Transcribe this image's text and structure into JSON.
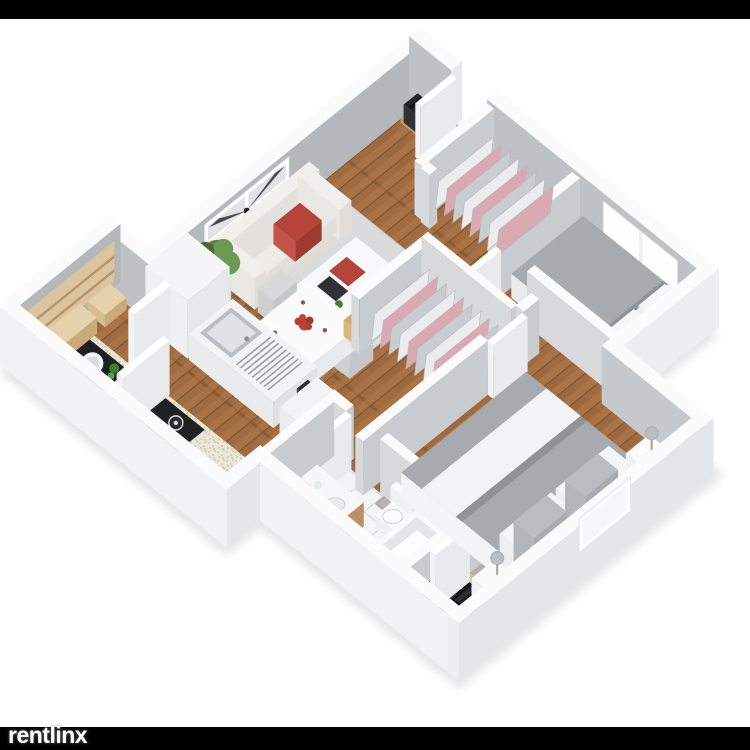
{
  "meta": {
    "image_type": "3d-isometric-floor-plan-render",
    "bedrooms": 2,
    "bathrooms": 1
  },
  "watermark": {
    "brand": "rentlinx"
  },
  "canvas": {
    "background": "#ffffff",
    "bar_color": "#000000",
    "watermark_color": "#ffffff"
  },
  "palette": {
    "wall_top": "#fbfbfc",
    "wall_inner": "#b5b8ba",
    "wall_inner_light": "#bfc2c4",
    "wall_outer_sw": "#f1f2f3",
    "wall_outer_se": "#e4e6e8",
    "wall_int_se": "#c9ccce",
    "wall_int_sw": "#d7d9db",
    "wood_a": "#a06b41",
    "wood_b": "#b07a4a",
    "wood_dark": "#7e5230",
    "tile": "#f3f4f5",
    "grout": "#c7cacc",
    "rug_living": "#d9dbdd",
    "rug_master": "#b9b1ac",
    "cream": "#edece7",
    "red": "#b5453a",
    "red_dark": "#9e3a30",
    "green": "#5c8346",
    "green_dark": "#47692f",
    "furn_wood": "#cda973",
    "furn_wood_light": "#dcc49e",
    "steel": "#b9bec2",
    "steel_light": "#dfe3e5",
    "black": "#202123",
    "bed_gray": "#a7abad",
    "linen_white": "#f2f3f4",
    "clothes_pink": "#d9a9b4",
    "clothes_gray": "#c9cdd0",
    "counter_base": "#eae6d8",
    "counter_dot": "#c6bfa8"
  },
  "scene": {
    "style": "isometric",
    "rooms": [
      {
        "name": "living-dining-room",
        "floor": "hardwood",
        "furniture": [
          "sofa",
          "red-throw-pillow",
          "wall-art",
          "potted-plant",
          "area-rug-living",
          "coffee-table",
          "pouf",
          "dining-chairs",
          "dining-table",
          "flower-centerpiece"
        ]
      },
      {
        "name": "entry-hall",
        "floor": "hardwood",
        "furniture": [
          "shoe-bench",
          "entry-door",
          "coat-closet",
          "tv-console",
          "television"
        ]
      },
      {
        "name": "bedroom-small",
        "floor": "hardwood",
        "furniture": [
          "bed-small",
          "bedroom-window",
          "closet-rack-small"
        ]
      },
      {
        "name": "bedroom-master",
        "floor": "hardwood",
        "furniture": [
          "area-rug-master",
          "double-bed",
          "nightstand-left",
          "nightstand-right",
          "table-lamps",
          "closet-master",
          "desk",
          "desk-monitor"
        ]
      },
      {
        "name": "kitchen",
        "floor": "hardwood",
        "furniture": [
          "refrigerator",
          "kitchen-island",
          "island-sink",
          "dish-rack",
          "washing-machine",
          "kitchen-counter",
          "gas-cooktop",
          "prep-basin",
          "pantry-closet"
        ]
      },
      {
        "name": "bathroom",
        "floor": "tile",
        "furniture": [
          "vanity-sink",
          "laundry-basket",
          "toilet",
          "bathtub"
        ]
      }
    ]
  }
}
